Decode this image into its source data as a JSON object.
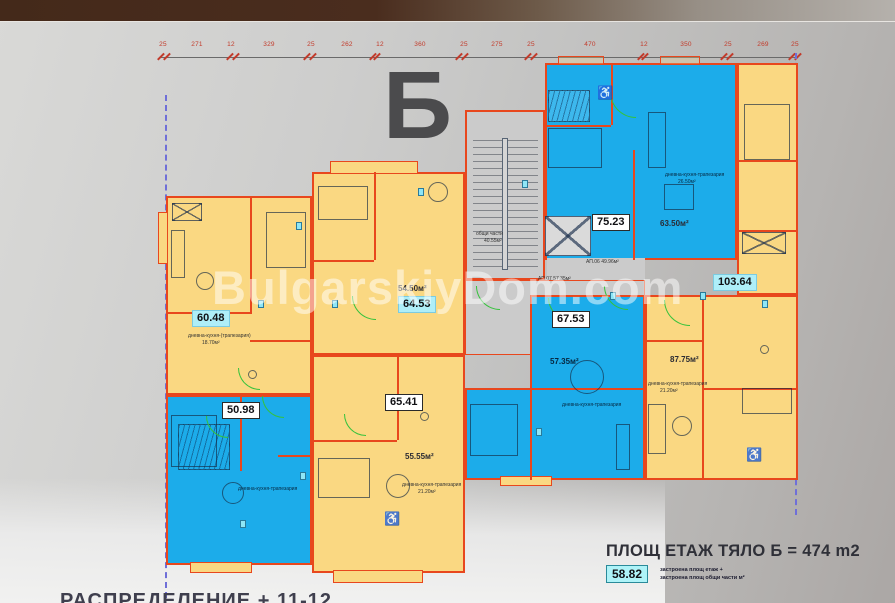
{
  "page": {
    "watermark": "BulgarskiyDom.com",
    "section_letter": "Б"
  },
  "dimensions": [
    "25",
    "271",
    "12",
    "329",
    "25",
    "262",
    "12",
    "360",
    "25",
    "275",
    "25",
    "470",
    "12",
    "350",
    "25",
    "269",
    "25"
  ],
  "apartments": [
    {
      "total": "60.48",
      "living_caption": "дневна-кухня-(трапезария)",
      "living_area": "18.70м²"
    },
    {
      "total": "50.98",
      "living_caption": "дневна-кухня-трапезария"
    },
    {
      "total": "64.53",
      "net": "54.50м²"
    },
    {
      "total": "65.41",
      "net": "55.55м²",
      "living_caption": "дневна-кухня-трапезария",
      "living_area": "21.20м²"
    },
    {
      "total": "75.23",
      "net": "63.50м²",
      "living_caption": "дневна-кухня-трапезария",
      "living_area": "26.50м²"
    },
    {
      "total": "67.53",
      "net": "57.35м²",
      "living_caption": "дневна-кухня-трапезария"
    },
    {
      "total": "103.64",
      "net": "87.75м²",
      "living_caption": "дневна-кухня-трапезария",
      "living_area": "21.20м²"
    }
  ],
  "common": {
    "label": "общи части",
    "area": "40.55м²",
    "note1": "АП.06 49.96м²",
    "note2": "АП.07 57.35м²"
  },
  "footer": {
    "floor_area_text": "ПЛОЩ ЕТАЖ ТЯЛО Б = 474 m2",
    "built_value": "58.82",
    "built_note1": "застроена площ етаж +",
    "built_note2": "застроена площ общи части м²",
    "bottom_caption": "РАСПРЕДЕЛЕНИЕ + 11-12"
  },
  "colors": {
    "apartment_blue": "#1cacea",
    "apartment_yellow": "#fad882",
    "wall_red": "#e8471d",
    "door_green": "#35c23c",
    "label_cyan": "#aeeef8",
    "dashed_line": "#6f6fd8",
    "top_bar_brown": "#4a2d1e"
  }
}
